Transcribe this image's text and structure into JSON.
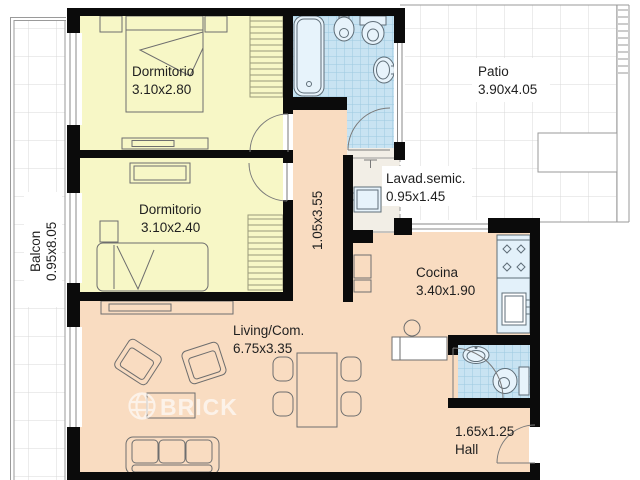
{
  "rooms": {
    "bedroom1": {
      "name": "Dormitorio",
      "dims": "3.10x2.80"
    },
    "bedroom2": {
      "name": "Dormitorio",
      "dims": "3.10x2.40"
    },
    "balcony": {
      "name": "Balcon",
      "dims": "0.95x8.05"
    },
    "patio": {
      "name": "Patio",
      "dims": "3.90x4.05"
    },
    "hallway": {
      "dims": "1.05x3.55"
    },
    "laundry": {
      "name": "Lavad.semic.",
      "dims": "0.95x1.45"
    },
    "kitchen": {
      "name": "Cocina",
      "dims": "3.40x1.90"
    },
    "living": {
      "name": "Living/Com.",
      "dims": "6.75x3.35"
    },
    "hall": {
      "name": "Hall",
      "dims": "1.65x1.25"
    }
  },
  "watermark": {
    "brand": "BRICK"
  },
  "colors": {
    "bedroom_fill": "#f7f7c6",
    "social_fill": "#f9dcc1",
    "bath_tile": "#c8e3f2",
    "tile_line": "#9dc9e0",
    "wall": "#0b0b0b",
    "laundry_floor": "#f2eee6",
    "kitchen_counter": "#e3f1fa",
    "grid_line": "#d8d8d8"
  }
}
